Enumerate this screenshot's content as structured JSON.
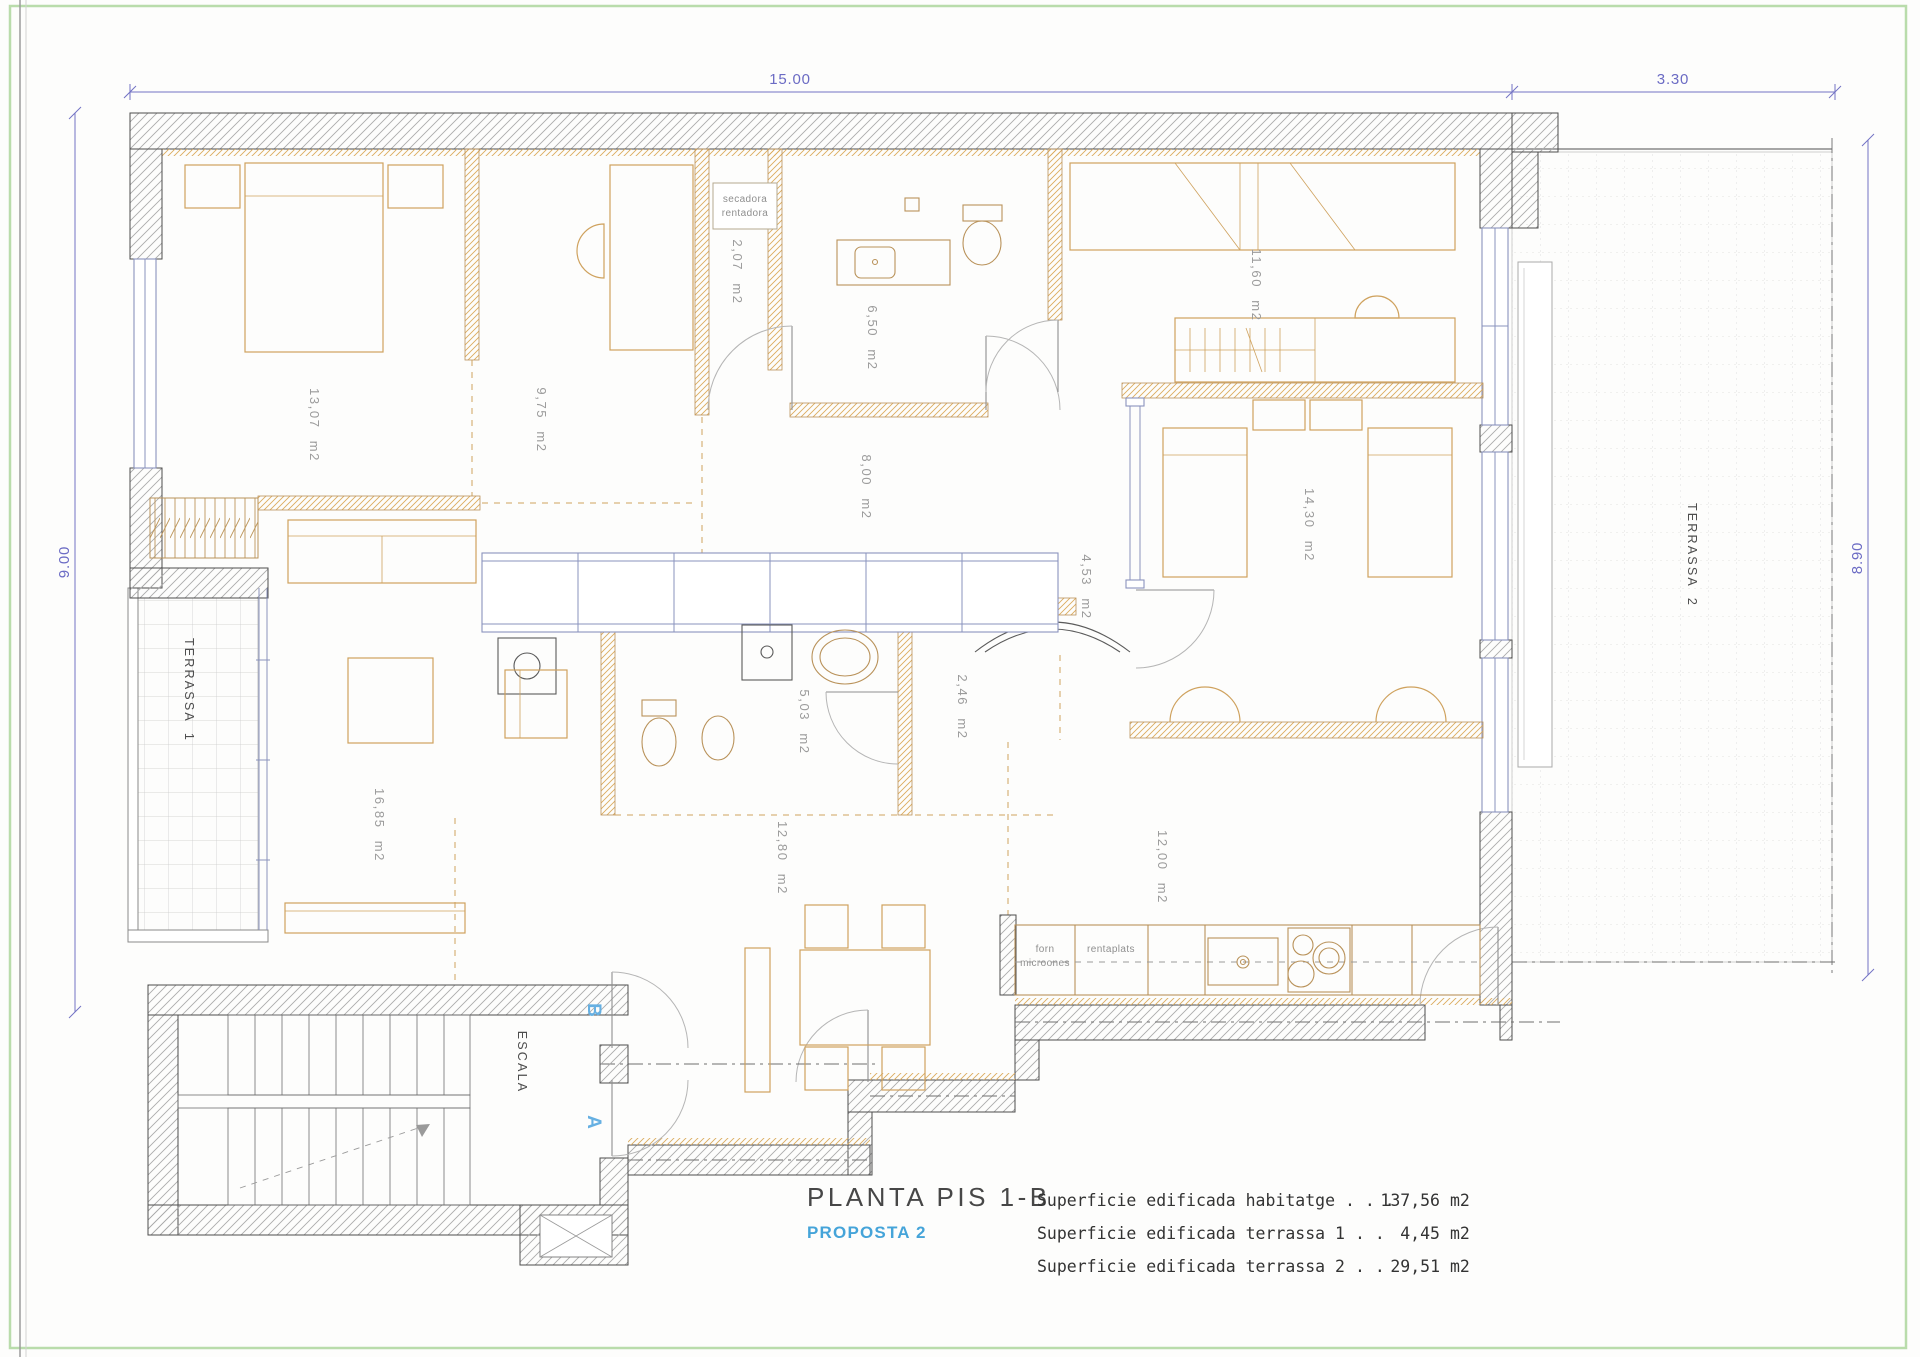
{
  "dimensions": {
    "top_main": "15.00",
    "top_right": "3.30",
    "left": "9.00",
    "right": "8.90"
  },
  "rooms": {
    "bedroom1": {
      "area": "13,07 m2"
    },
    "bedroom2": {
      "area": "9,75 m2"
    },
    "laundry": {
      "area": "2,07 m2"
    },
    "bathroom1": {
      "area": "6,50 m2"
    },
    "hall": {
      "area": "8,00 m2"
    },
    "bedroom3": {
      "area": "11,60 m2"
    },
    "bedroom4": {
      "area": "14,30 m2"
    },
    "corridor": {
      "area": "4,53 m2"
    },
    "bathroom2": {
      "area": "5,03 m2"
    },
    "pantry": {
      "area": "2,46 m2"
    },
    "living": {
      "area": "16,85 m2"
    },
    "dining": {
      "area": "12,80 m2"
    },
    "kitchen": {
      "area": "12,00 m2"
    }
  },
  "terraces": {
    "t1": "TERRASSA 1",
    "t2": "TERRASSA 2"
  },
  "stairwell": {
    "label": "ESCALA",
    "door_b": "B",
    "door_a": "A"
  },
  "laundry_appliances": {
    "line1": "secadora",
    "line2": "rentadora"
  },
  "kitchen_appliances": {
    "forn1": "forn",
    "forn2": "microones",
    "rentaplats": "rentaplats"
  },
  "title_block": {
    "title": "PLANTA PIS 1-B",
    "proposal": "PROPOSTA 2",
    "unit": "m2",
    "rows": [
      {
        "label": "Superficie edificada habitatge",
        "dots": ". . .",
        "value": "137,56"
      },
      {
        "label": "Superficie edificada terrassa 1",
        "dots": ". .",
        "value": "4,45"
      },
      {
        "label": "Superficie edificada terrassa 2",
        "dots": ". .",
        "value": "29,51"
      }
    ]
  },
  "colors": {
    "dimension_blue": "#7272c4",
    "furniture_tan": "#cfa25e",
    "proposal_cyan": "#45a4d9",
    "door_letter_blue": "#66b0e2",
    "page_border_green": "#b9dcab"
  }
}
